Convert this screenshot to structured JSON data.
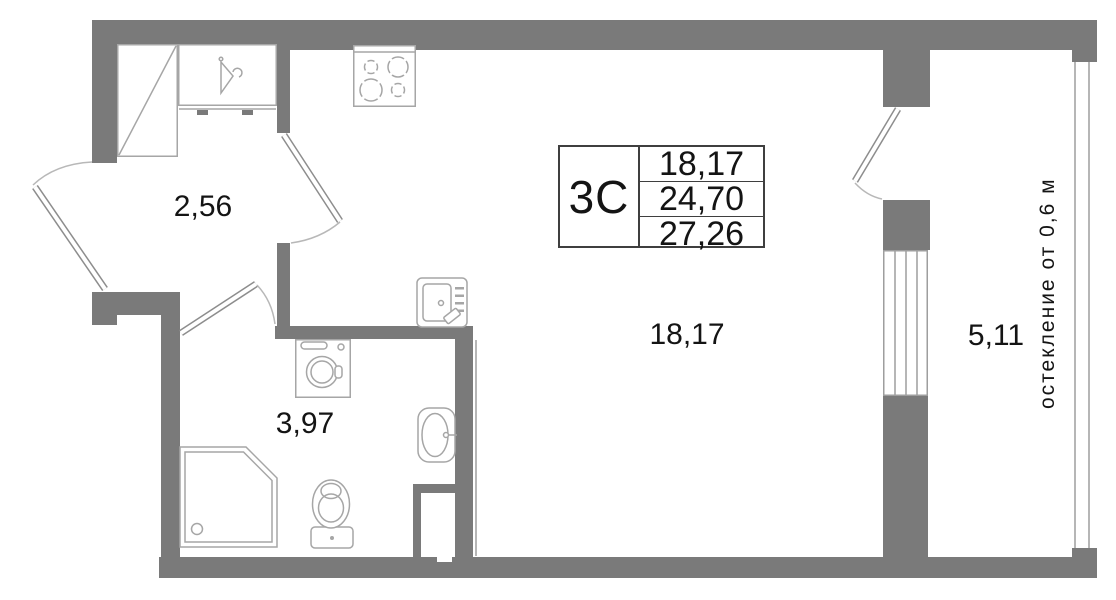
{
  "plan_title": "studio apartment floor plan",
  "info_table": {
    "unit_type": "3С",
    "values": [
      "18,17",
      "24,70",
      "27,26"
    ]
  },
  "rooms": [
    {
      "id": "hallway",
      "area": "2,56"
    },
    {
      "id": "bathroom",
      "area": "3,97"
    },
    {
      "id": "living-kitchen",
      "area": "18,17"
    },
    {
      "id": "balcony",
      "area": "5,11"
    }
  ],
  "annotations": {
    "glazing_note": "остекление от 0,6 м"
  },
  "fixtures": [
    "wardrobe",
    "hanger-closet",
    "stove",
    "electrical-panel",
    "washing-machine",
    "sink",
    "shower",
    "toilet",
    "entrance-door",
    "living-room-door",
    "bathroom-door",
    "balcony-door",
    "balcony-window"
  ],
  "colors": {
    "wall": "#7a7a7a",
    "thin_line": "#9e9e9e",
    "fixture_line": "#a6a6a6",
    "door_arc": "#b8b8b8",
    "text": "#141414",
    "table_border": "#3f3f3f"
  }
}
